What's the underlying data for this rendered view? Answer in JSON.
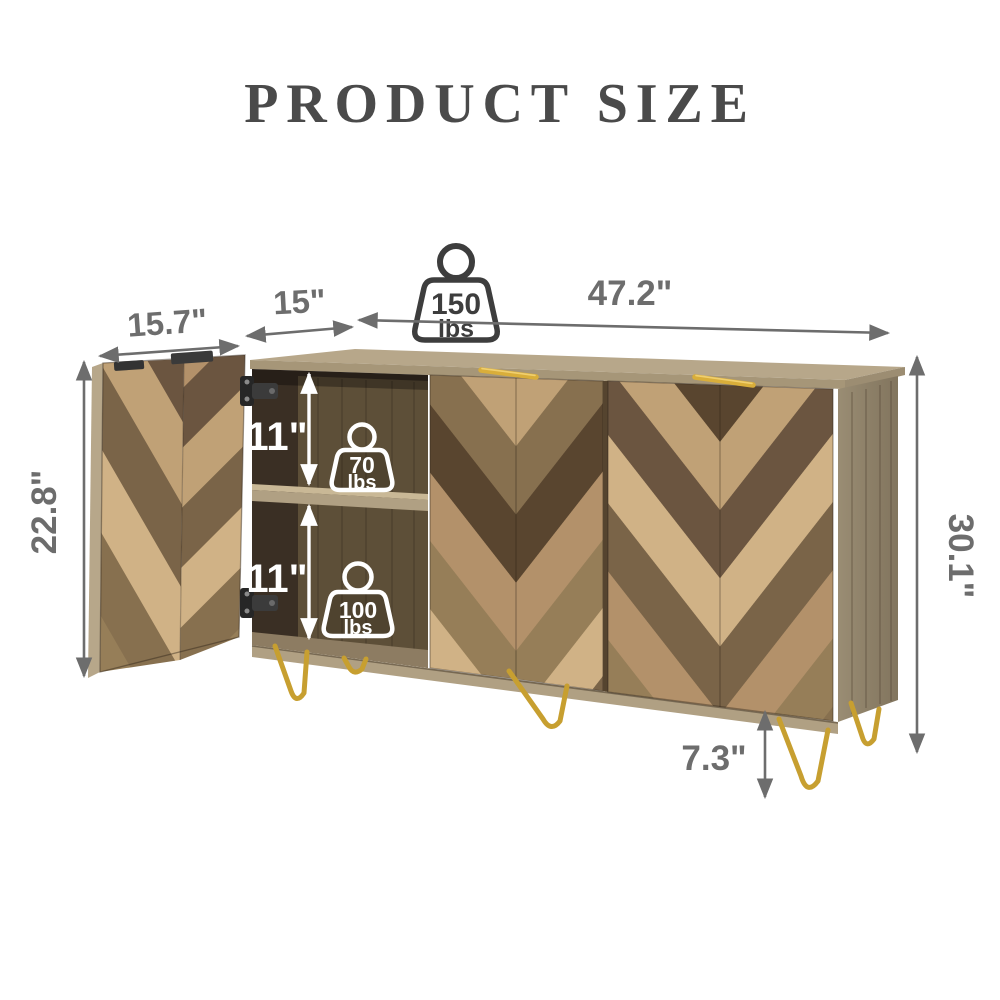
{
  "title": "PRODUCT SIZE",
  "dims": {
    "door_w": "15.7\"",
    "depth": "15\"",
    "width": "47.2\"",
    "door_h": "22.8\"",
    "shelf_upper": "11\"",
    "shelf_lower": "11\"",
    "height": "30.1\"",
    "leg_h": "7.3\""
  },
  "caps": {
    "top": {
      "value": "150",
      "unit": "lbs"
    },
    "middle": {
      "value": "70",
      "unit": "lbs"
    },
    "bottom": {
      "value": "100",
      "unit": "lbs"
    }
  },
  "icons": {
    "top_capacity": "weight-icon",
    "middle_capacity": "weight-icon",
    "bottom_capacity": "weight-icon"
  },
  "colors": {
    "title": "#4a4a4a",
    "dimension": "#6d6d6d",
    "gold": "#c79f30",
    "top_wood": "#b7a78a",
    "side_wood": "#95886f",
    "interior_dark": "#3a2f24",
    "white_label": "#ffffff"
  }
}
